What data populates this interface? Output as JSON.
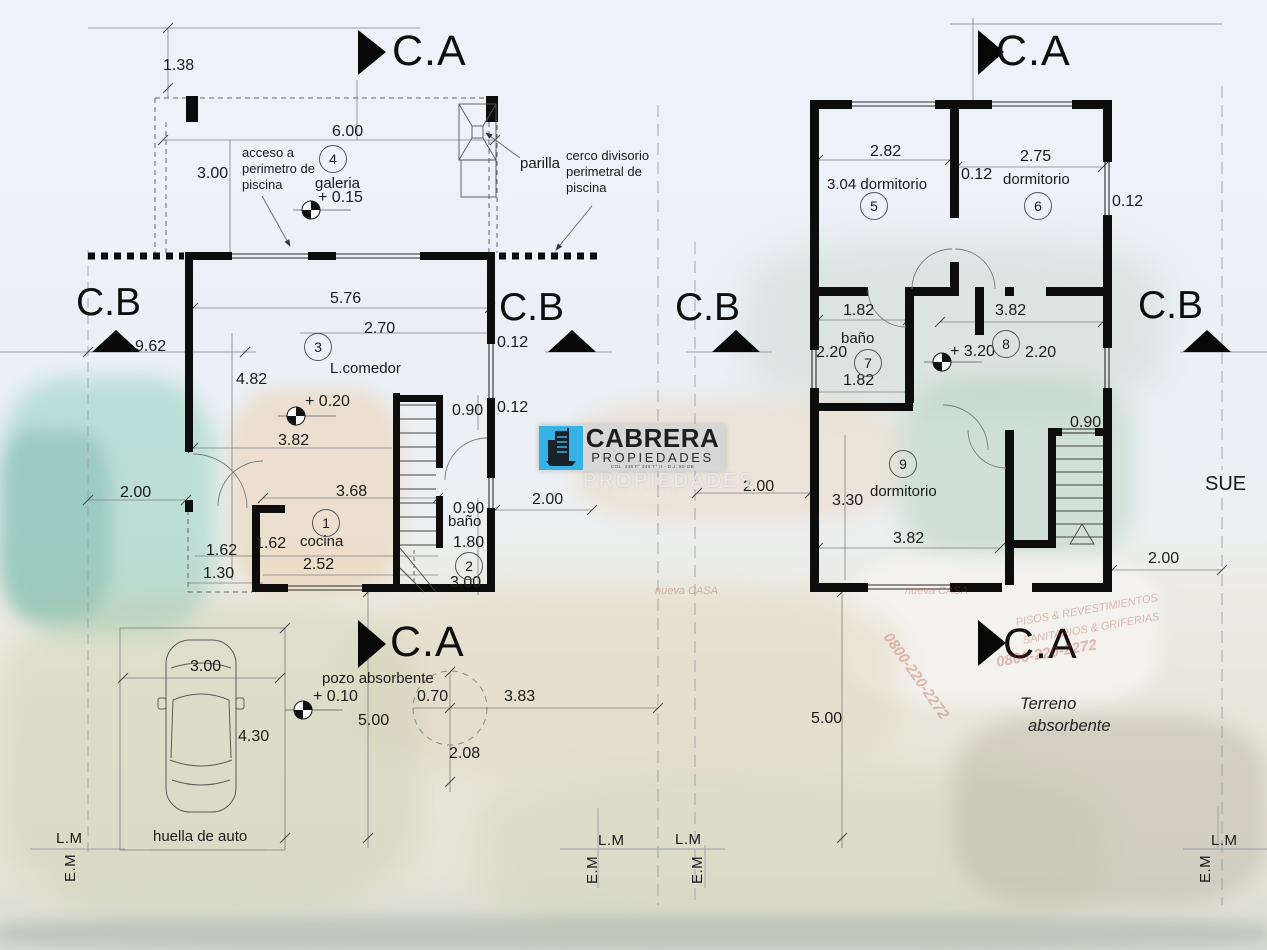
{
  "logo": {
    "brand": "CABRERA",
    "subtitle": "PROPIEDADES",
    "registration": "COL. 348 F° 348 T° II - D.J. 50-GB",
    "ghost": "PROPIEDADES",
    "accent_color": "#35b3e7",
    "panel_color": "#d6d6d6"
  },
  "drawing": {
    "markers_ca": [
      {
        "t": "C.A",
        "x": 392,
        "y": 30
      },
      {
        "t": "C.A",
        "x": 996,
        "y": 30
      },
      {
        "t": "C.A",
        "x": 390,
        "y": 621
      },
      {
        "t": "C.A",
        "x": 1003,
        "y": 623
      }
    ],
    "markers_cb": [
      {
        "t": "C.B",
        "x": 76,
        "y": 283
      },
      {
        "t": "C.B",
        "x": 499,
        "y": 288
      },
      {
        "t": "C.B",
        "x": 675,
        "y": 288
      },
      {
        "t": "C.B",
        "x": 1138,
        "y": 286
      }
    ],
    "bubbles": [
      {
        "t": "4",
        "x": 332,
        "y": 158
      },
      {
        "t": "3",
        "x": 317,
        "y": 346
      },
      {
        "t": "1",
        "x": 325,
        "y": 522
      },
      {
        "t": "2",
        "x": 468,
        "y": 565
      },
      {
        "t": "5",
        "x": 873,
        "y": 205
      },
      {
        "t": "6",
        "x": 1037,
        "y": 205
      },
      {
        "t": "7",
        "x": 867,
        "y": 362
      },
      {
        "t": "8",
        "x": 1005,
        "y": 343
      },
      {
        "t": "9",
        "x": 902,
        "y": 463
      }
    ],
    "rooms": [
      {
        "t": "galeria",
        "x": 315,
        "y": 176
      },
      {
        "t": "L.comedor",
        "x": 330,
        "y": 361
      },
      {
        "t": "cocina",
        "x": 300,
        "y": 534
      },
      {
        "t": "baño",
        "x": 448,
        "y": 514
      },
      {
        "t": "3.04 dormitorio",
        "x": 827,
        "y": 177
      },
      {
        "t": "dormitorio",
        "x": 1003,
        "y": 172
      },
      {
        "t": "baño",
        "x": 841,
        "y": 331
      },
      {
        "t": "dormitorio",
        "x": 870,
        "y": 484
      }
    ],
    "levels": [
      {
        "t": "+ 0.15",
        "x": 318,
        "y": 190
      },
      {
        "t": "+ 0.20",
        "x": 305,
        "y": 394
      },
      {
        "t": "+ 3.20",
        "x": 950,
        "y": 344
      },
      {
        "t": "+ 0.10",
        "x": 313,
        "y": 689
      }
    ],
    "dims": [
      {
        "t": "1.38",
        "x": 163,
        "y": 58
      },
      {
        "t": "6.00",
        "x": 332,
        "y": 124
      },
      {
        "t": "3.00",
        "x": 197,
        "y": 166
      },
      {
        "t": "5.76",
        "x": 330,
        "y": 291
      },
      {
        "t": "9.62",
        "x": 135,
        "y": 339
      },
      {
        "t": "2.70",
        "x": 364,
        "y": 321
      },
      {
        "t": "0.12",
        "x": 497,
        "y": 335
      },
      {
        "t": "4.82",
        "x": 236,
        "y": 372
      },
      {
        "t": "3.82",
        "x": 278,
        "y": 433
      },
      {
        "t": "0.90",
        "x": 452,
        "y": 403
      },
      {
        "t": "0.12",
        "x": 497,
        "y": 400
      },
      {
        "t": "2.00",
        "x": 120,
        "y": 485
      },
      {
        "t": "3.68",
        "x": 336,
        "y": 484
      },
      {
        "t": "1.62",
        "x": 255,
        "y": 536
      },
      {
        "t": "1.62",
        "x": 206,
        "y": 543
      },
      {
        "t": "2.52",
        "x": 303,
        "y": 557
      },
      {
        "t": "1.30",
        "x": 203,
        "y": 566
      },
      {
        "t": "0.90",
        "x": 453,
        "y": 501
      },
      {
        "t": "1.80",
        "x": 453,
        "y": 535
      },
      {
        "t": "3.00",
        "x": 450,
        "y": 575
      },
      {
        "t": "2.00",
        "x": 532,
        "y": 492
      },
      {
        "t": "3.00",
        "x": 190,
        "y": 659
      },
      {
        "t": "4.30",
        "x": 238,
        "y": 729
      },
      {
        "t": "5.00",
        "x": 358,
        "y": 713
      },
      {
        "t": "0.70",
        "x": 417,
        "y": 689
      },
      {
        "t": "3.83",
        "x": 504,
        "y": 689
      },
      {
        "t": "2.08",
        "x": 449,
        "y": 746
      },
      {
        "t": "2.82",
        "x": 870,
        "y": 144
      },
      {
        "t": "0.12",
        "x": 961,
        "y": 167
      },
      {
        "t": "2.75",
        "x": 1020,
        "y": 149
      },
      {
        "t": "0.12",
        "x": 1112,
        "y": 194
      },
      {
        "t": "1.82",
        "x": 843,
        "y": 303
      },
      {
        "t": "3.82",
        "x": 995,
        "y": 303
      },
      {
        "t": "2.20",
        "x": 816,
        "y": 345
      },
      {
        "t": "1.82",
        "x": 843,
        "y": 373
      },
      {
        "t": "2.20",
        "x": 1025,
        "y": 345
      },
      {
        "t": "0.90",
        "x": 1070,
        "y": 415
      },
      {
        "t": "3.30",
        "x": 832,
        "y": 493
      },
      {
        "t": "3.82",
        "x": 893,
        "y": 531
      },
      {
        "t": "2.00",
        "x": 743,
        "y": 479
      },
      {
        "t": "2.00",
        "x": 1148,
        "y": 551
      },
      {
        "t": "5.00",
        "x": 811,
        "y": 711
      }
    ],
    "notes": [
      {
        "t": "acceso a",
        "x": 242,
        "y": 146
      },
      {
        "t": "perimetro de",
        "x": 242,
        "y": 162
      },
      {
        "t": "piscina",
        "x": 242,
        "y": 178
      },
      {
        "t": "parilla",
        "x": 520,
        "y": 156,
        "c": "n15"
      },
      {
        "t": "cerco divisorio",
        "x": 566,
        "y": 149
      },
      {
        "t": "perimetral de",
        "x": 566,
        "y": 165
      },
      {
        "t": "piscina",
        "x": 566,
        "y": 181
      },
      {
        "t": "pozo absorbente",
        "x": 322,
        "y": 671,
        "c": "n15"
      },
      {
        "t": "huella de auto",
        "x": 153,
        "y": 829,
        "c": "n15"
      },
      {
        "t": "Terreno",
        "x": 1020,
        "y": 696,
        "c": "it"
      },
      {
        "t": "absorbente",
        "x": 1028,
        "y": 718,
        "c": "it"
      },
      {
        "t": "SUE",
        "x": 1205,
        "y": 474,
        "c": "sue"
      }
    ],
    "edges": [
      {
        "t": "L.M",
        "x": 56,
        "y": 831
      },
      {
        "t": "E.M",
        "x": 63,
        "y": 882,
        "r": -90
      },
      {
        "t": "L.M",
        "x": 598,
        "y": 833
      },
      {
        "t": "E.M",
        "x": 585,
        "y": 884,
        "r": -90
      },
      {
        "t": "L.M",
        "x": 675,
        "y": 832
      },
      {
        "t": "E.M",
        "x": 690,
        "y": 884,
        "r": -90
      },
      {
        "t": "L.M",
        "x": 1211,
        "y": 833
      },
      {
        "t": "E.M",
        "x": 1198,
        "y": 883,
        "r": -90
      }
    ],
    "photo_texts": [
      {
        "t": "PISOS & REVESTIMIENTOS",
        "x": 1015,
        "y": 618,
        "r": -10
      },
      {
        "t": "SANITARIOS & GRIFERIAS",
        "x": 1022,
        "y": 636,
        "r": -10
      },
      {
        "t": "0800-220-2272",
        "x": 995,
        "y": 655,
        "r": -10,
        "c": "ph-big"
      },
      {
        "t": "0800-220-2272",
        "x": 893,
        "y": 630,
        "r": 55,
        "c": "ph-big"
      },
      {
        "t": "nueva CASA",
        "x": 905,
        "y": 586
      },
      {
        "t": "nueva CASA",
        "x": 655,
        "y": 586
      }
    ]
  }
}
